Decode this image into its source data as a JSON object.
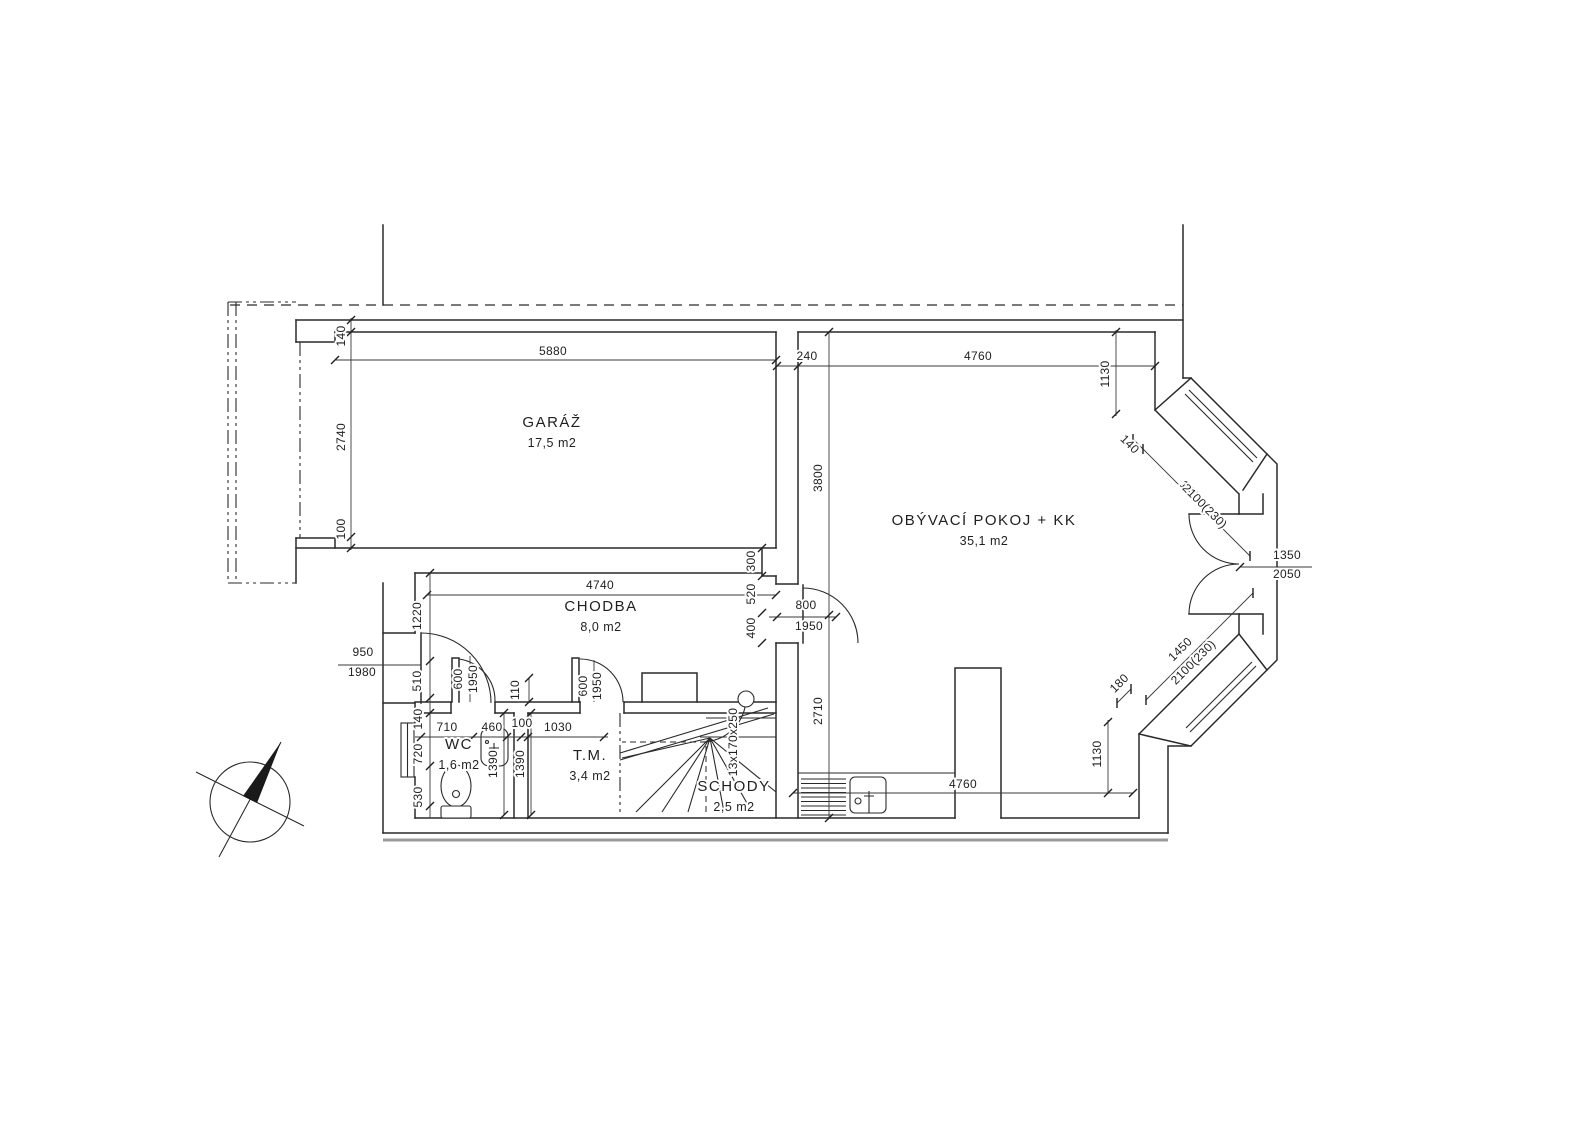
{
  "drawing": {
    "type": "architectural-floor-plan",
    "colors": {
      "line": "#2a2a2a",
      "heavy_section": "#9a9a9a",
      "background": "#ffffff"
    },
    "rooms": [
      {
        "id": "garaz",
        "name": "GARÁŽ",
        "area": "17,5 m2",
        "x": 552,
        "y": 427
      },
      {
        "id": "obyvaci-pokoj",
        "name": "OBÝVACÍ POKOJ + KK",
        "area": "35,1 m2",
        "x": 984,
        "y": 525
      },
      {
        "id": "chodba",
        "name": "CHODBA",
        "area": "8,0 m2",
        "x": 601,
        "y": 611
      },
      {
        "id": "wc",
        "name": "WC",
        "area": "1,6 m2",
        "x": 459,
        "y": 749
      },
      {
        "id": "tm",
        "name": "T.M.",
        "area": "3,4 m2",
        "x": 590,
        "y": 760
      },
      {
        "id": "schody",
        "name": "SCHODY",
        "area": "2,5 m2",
        "x": 734,
        "y": 791
      }
    ],
    "dimensions": [
      {
        "t": "140",
        "x": 345,
        "y": 336,
        "r": -90
      },
      {
        "t": "5880",
        "x": 553,
        "y": 355,
        "r": 0
      },
      {
        "t": "2740",
        "x": 345,
        "y": 437,
        "r": -90
      },
      {
        "t": "100",
        "x": 345,
        "y": 529,
        "r": -90
      },
      {
        "t": "240",
        "x": 807,
        "y": 360,
        "r": 0
      },
      {
        "t": "4760",
        "x": 978,
        "y": 360,
        "r": 0
      },
      {
        "t": "1130",
        "x": 1109,
        "y": 374,
        "r": -90
      },
      {
        "t": "140",
        "x": 1127,
        "y": 447,
        "r": 45
      },
      {
        "t": "1450",
        "x": 1189,
        "y": 495,
        "r": 45
      },
      {
        "t": "2100(230)",
        "x": 1202,
        "y": 509,
        "r": 45
      },
      {
        "t": "3800",
        "x": 822,
        "y": 478,
        "r": -90
      },
      {
        "t": "1350",
        "x": 1287,
        "y": 559,
        "r": 0
      },
      {
        "t": "2050",
        "x": 1287,
        "y": 578,
        "r": 0
      },
      {
        "t": "1450",
        "x": 1183,
        "y": 652,
        "r": -45
      },
      {
        "t": "2100(230)",
        "x": 1196,
        "y": 665,
        "r": -45
      },
      {
        "t": "180",
        "x": 1122,
        "y": 686,
        "r": -45
      },
      {
        "t": "1130",
        "x": 1101,
        "y": 754,
        "r": -90
      },
      {
        "t": "4760",
        "x": 963,
        "y": 788,
        "r": 0
      },
      {
        "t": "2710",
        "x": 822,
        "y": 711,
        "r": -90
      },
      {
        "t": "300",
        "x": 755,
        "y": 561,
        "r": -90
      },
      {
        "t": "520",
        "x": 755,
        "y": 594,
        "r": -90
      },
      {
        "t": "400",
        "x": 755,
        "y": 628,
        "r": -90
      },
      {
        "t": "800",
        "x": 806,
        "y": 609,
        "r": 0
      },
      {
        "t": "1950",
        "x": 809,
        "y": 630,
        "r": 0
      },
      {
        "t": "4740",
        "x": 600,
        "y": 589,
        "r": 0
      },
      {
        "t": "1220",
        "x": 421,
        "y": 616,
        "r": -90
      },
      {
        "t": "950",
        "x": 363,
        "y": 656,
        "r": 0
      },
      {
        "t": "1980",
        "x": 362,
        "y": 676,
        "r": 0
      },
      {
        "t": "510",
        "x": 421,
        "y": 681,
        "r": -90
      },
      {
        "t": "600",
        "x": 462,
        "y": 679,
        "r": -90
      },
      {
        "t": "1950",
        "x": 477,
        "y": 679,
        "r": -90
      },
      {
        "t": "110",
        "x": 519,
        "y": 690,
        "r": -90
      },
      {
        "t": "600",
        "x": 587,
        "y": 686,
        "r": -90
      },
      {
        "t": "1950",
        "x": 601,
        "y": 686,
        "r": -90
      },
      {
        "t": "140",
        "x": 422,
        "y": 719,
        "r": -90
      },
      {
        "t": "710",
        "x": 447,
        "y": 731,
        "r": 0
      },
      {
        "t": "460",
        "x": 492,
        "y": 731,
        "r": 0
      },
      {
        "t": "100",
        "x": 522,
        "y": 727,
        "r": 0
      },
      {
        "t": "1030",
        "x": 558,
        "y": 731,
        "r": 0
      },
      {
        "t": "720",
        "x": 422,
        "y": 754,
        "r": -90
      },
      {
        "t": "530",
        "x": 422,
        "y": 797,
        "r": -90
      },
      {
        "t": "1390",
        "x": 497,
        "y": 764,
        "r": -90
      },
      {
        "t": "1390",
        "x": 524,
        "y": 764,
        "r": -90
      },
      {
        "t": "13x170x250",
        "x": 737,
        "y": 742,
        "r": -90
      }
    ]
  }
}
